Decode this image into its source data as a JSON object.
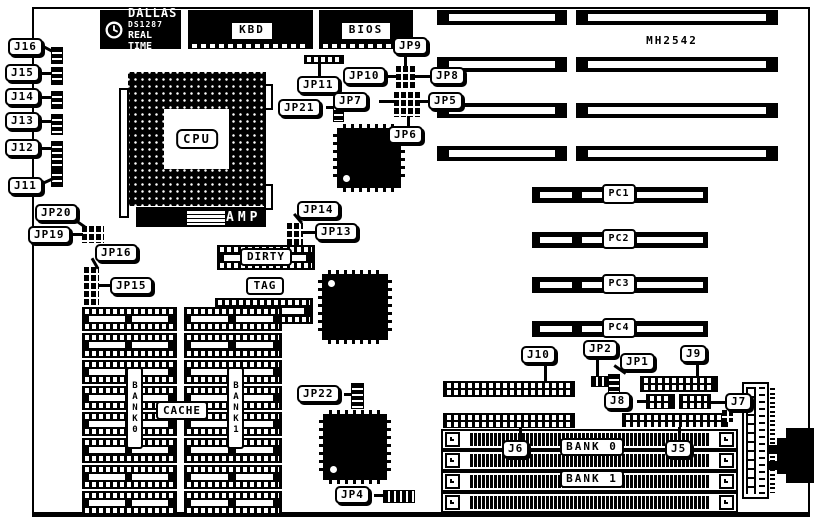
{
  "logo": {
    "brand": "DALLAS",
    "part": "DS1287",
    "tagline": "REAL TIME"
  },
  "model": "MH2542",
  "chips": {
    "kbd": "KBD",
    "bios": "BIOS",
    "cpu": "CPU",
    "amp": "AMP",
    "dirty": "DIRTY",
    "tag": "TAG"
  },
  "cache": {
    "label": "CACHE",
    "bank0_vertical": "BANK0",
    "bank1_vertical": "BANK1",
    "rows_per_bank": 8
  },
  "memory": {
    "bank0": "BANK 0",
    "bank1": "BANK 1"
  },
  "pc_slots": [
    "PC1",
    "PC2",
    "PC3",
    "PC4"
  ],
  "callouts": {
    "j16": "J16",
    "j15": "J15",
    "j14": "J14",
    "j13": "J13",
    "j12": "J12",
    "j11": "J11",
    "jp20": "JP20",
    "jp19": "JP19",
    "jp16": "JP16",
    "jp15": "JP15",
    "jp11": "JP11",
    "jp21": "JP21",
    "jp10": "JP10",
    "jp9": "JP9",
    "jp8": "JP8",
    "jp7": "JP7",
    "jp5": "JP5",
    "jp6": "JP6",
    "jp14": "JP14",
    "jp13": "JP13",
    "jp22": "JP22",
    "jp4": "JP4",
    "j10": "J10",
    "jp2": "JP2",
    "jp1": "JP1",
    "j9": "J9",
    "j8": "J8",
    "j7": "J7",
    "j6": "J6",
    "j5": "J5"
  },
  "colors": {
    "ink": "#000000",
    "paper": "#ffffff"
  }
}
